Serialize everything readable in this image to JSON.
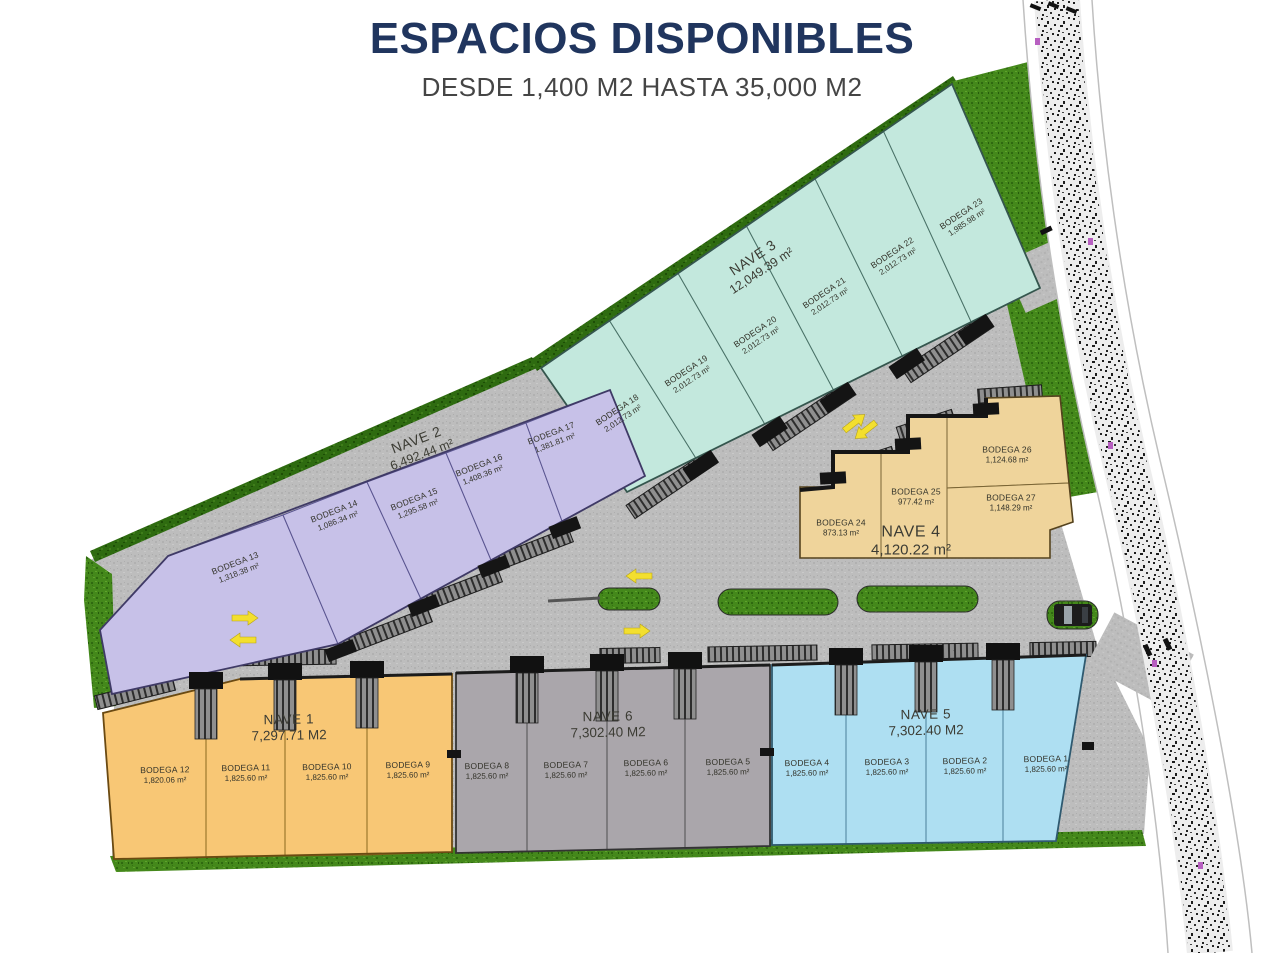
{
  "header": {
    "title": "ESPACIOS DISPONIBLES",
    "subtitle": "DESDE 1,400 M2 HASTA 35,000 M2",
    "title_color": "#20355e"
  },
  "naves": [
    {
      "name": "NAVE 1",
      "area": "7,297.71 M2",
      "fill": "#f8c775",
      "bodegas": [
        {
          "name": "BODEGA 12",
          "area": "1,820.06 m²"
        },
        {
          "name": "BODEGA 11",
          "area": "1,825.60 m²"
        },
        {
          "name": "BODEGA 10",
          "area": "1,825.60 m²"
        },
        {
          "name": "BODEGA 9",
          "area": "1,825.60 m²"
        }
      ]
    },
    {
      "name": "NAVE 2",
      "area": "6,492.44 m²",
      "fill": "#c7c1e8",
      "bodegas": [
        {
          "name": "BODEGA 13",
          "area": "1,318.38 m²"
        },
        {
          "name": "BODEGA 14",
          "area": "1,086.34 m²"
        },
        {
          "name": "BODEGA 15",
          "area": "1,295.58 m²"
        },
        {
          "name": "BODEGA 16",
          "area": "1,408.36 m²"
        },
        {
          "name": "BODEGA 17",
          "area": "1,381.81 m²"
        }
      ]
    },
    {
      "name": "NAVE 3",
      "area": "12,049.39 m²",
      "fill": "#c3e8dd",
      "bodegas": [
        {
          "name": "BODEGA 18",
          "area": "2,012.73 m²"
        },
        {
          "name": "BODEGA 19",
          "area": "2,012.73 m²"
        },
        {
          "name": "BODEGA 20",
          "area": "2,012.73 m²"
        },
        {
          "name": "BODEGA 21",
          "area": "2,012.73 m²"
        },
        {
          "name": "BODEGA 22",
          "area": "2,012.73 m²"
        },
        {
          "name": "BODEGA 23",
          "area": "1,985.98 m²"
        }
      ]
    },
    {
      "name": "NAVE 4",
      "area": "4,120.22 m²",
      "fill": "#efd49b",
      "bodegas": [
        {
          "name": "BODEGA 24",
          "area": "873.13 m²"
        },
        {
          "name": "BODEGA 25",
          "area": "977.42 m²"
        },
        {
          "name": "BODEGA 26",
          "area": "1,124.68 m²"
        },
        {
          "name": "BODEGA 27",
          "area": "1,148.29 m²"
        }
      ]
    },
    {
      "name": "NAVE 5",
      "area": "7,302.40 M2",
      "fill": "#aedff2",
      "bodegas": [
        {
          "name": "BODEGA 4",
          "area": "1,825.60 m²"
        },
        {
          "name": "BODEGA 3",
          "area": "1,825.60 m²"
        },
        {
          "name": "BODEGA 2",
          "area": "1,825.60 m²"
        },
        {
          "name": "BODEGA 1",
          "area": "1,825.60 m²"
        }
      ]
    },
    {
      "name": "NAVE 6",
      "area": "7,302.40 M2",
      "fill": "#aaa6ab",
      "bodegas": [
        {
          "name": "BODEGA 8",
          "area": "1,825.60 m²"
        },
        {
          "name": "BODEGA 7",
          "area": "1,825.60 m²"
        },
        {
          "name": "BODEGA 6",
          "area": "1,825.60 m²"
        },
        {
          "name": "BODEGA 5",
          "area": "1,825.60 m²"
        }
      ]
    }
  ]
}
